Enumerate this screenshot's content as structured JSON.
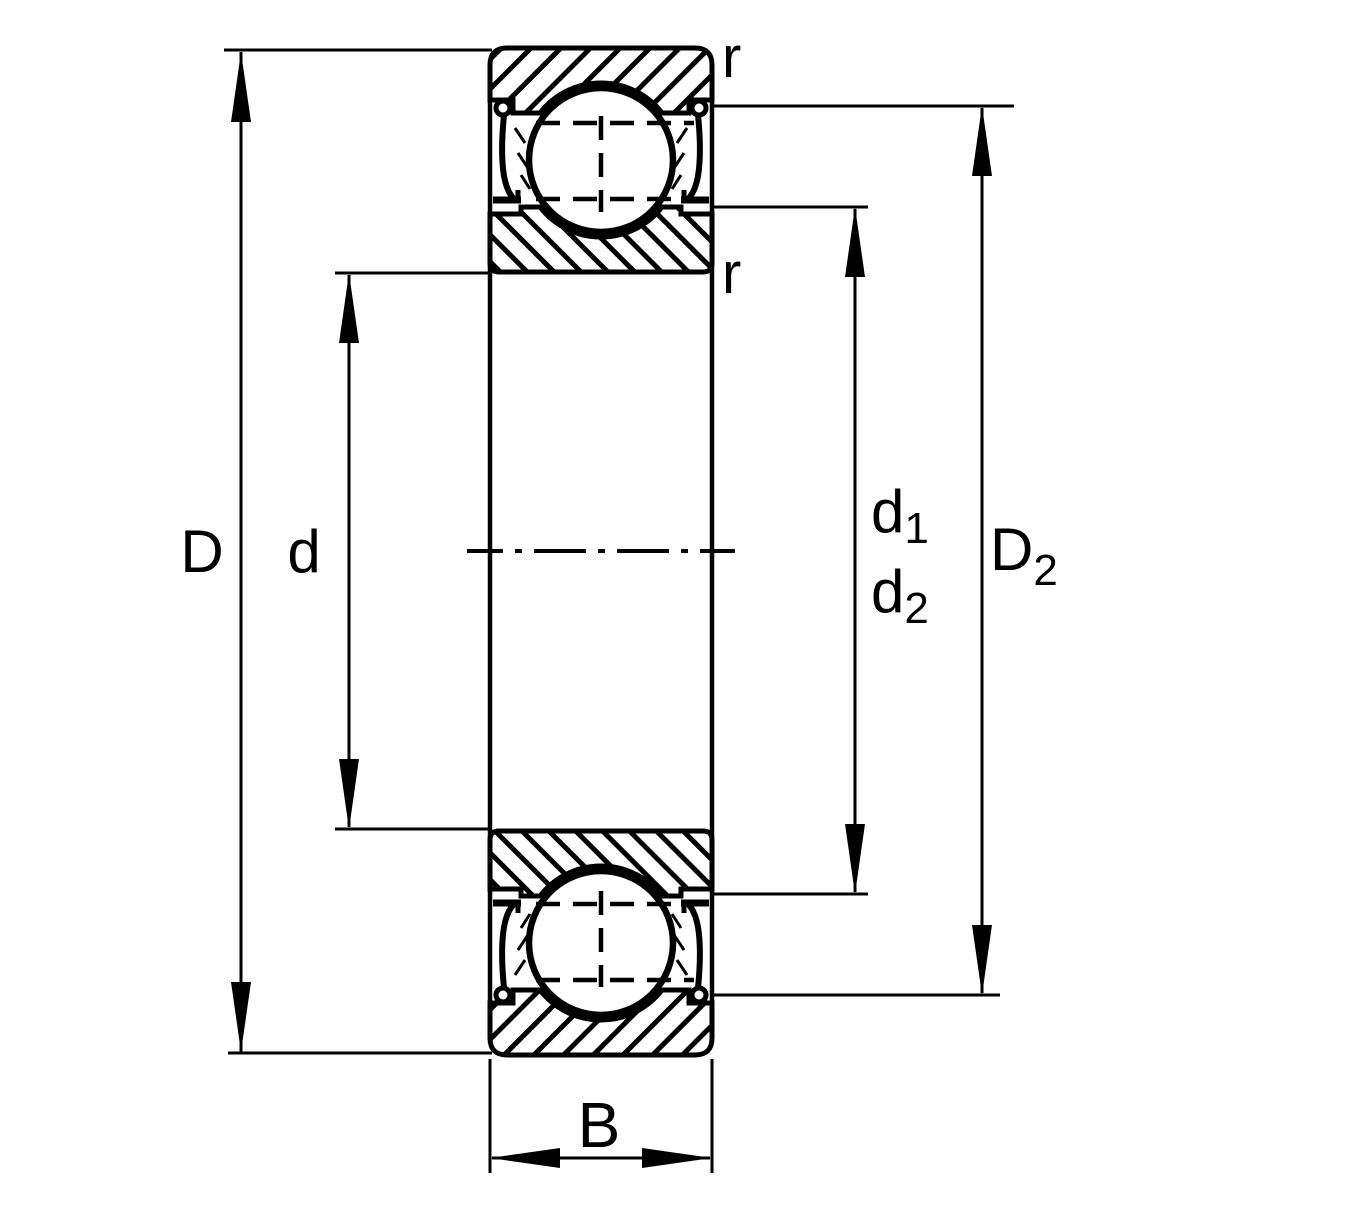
{
  "labels": {
    "D": "D",
    "d": "d",
    "d1": {
      "base": "d",
      "sub": "1"
    },
    "d2": {
      "base": "d",
      "sub": "2"
    },
    "D2": {
      "base": "D",
      "sub": "2"
    },
    "B": "B",
    "r_top": "r",
    "r_bottom": "r"
  },
  "colors": {
    "ink": "#000000",
    "background": "#ffffff"
  }
}
